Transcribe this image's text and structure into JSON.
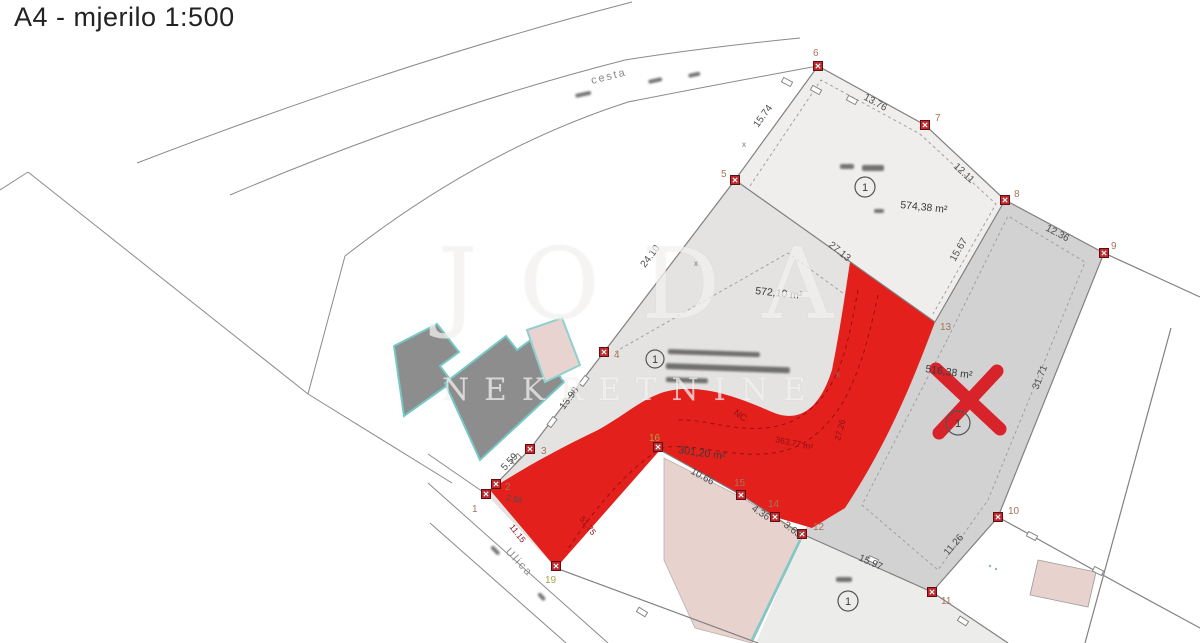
{
  "title": "A4 - mjerilo 1:500",
  "watermark": {
    "line1": "JODA",
    "line2": "NEKRETNINE"
  },
  "roads": {
    "top_road": "cesta",
    "bottom_street": "Ulica"
  },
  "areas": [
    "574,38 m²",
    "572,10 m²",
    "516,38 m²",
    "301,20 m²"
  ],
  "measurements": [
    "15.74",
    "13.76",
    "12.11",
    "12.36",
    "15.67",
    "27.13",
    "24.10",
    "13.98",
    "5.59",
    "31.71",
    "11.26",
    "15.97",
    "3.63",
    "4.36",
    "10.66",
    "2.58"
  ],
  "red_labels": [
    "NC",
    "363,77 m²",
    "27.26",
    "11.15",
    "51.75"
  ],
  "markers": [
    "1",
    "2",
    "3",
    "4",
    "5",
    "6",
    "7",
    "8",
    "9",
    "10",
    "11",
    "12",
    "13",
    "14",
    "15",
    "16",
    "19"
  ],
  "circled_marker": "1",
  "colors": {
    "road_red": "#e3201c",
    "marker_red": "#c1272d",
    "parcel_light": "#efeeec",
    "parcel_mid": "#e4e3e1",
    "parcel_dark": "#d2d2d2",
    "parcel_bottom": "#ececea",
    "building_gray": "#8d8d8d",
    "building_outline": "#76c8c6",
    "pink": "#e7d2ce"
  }
}
